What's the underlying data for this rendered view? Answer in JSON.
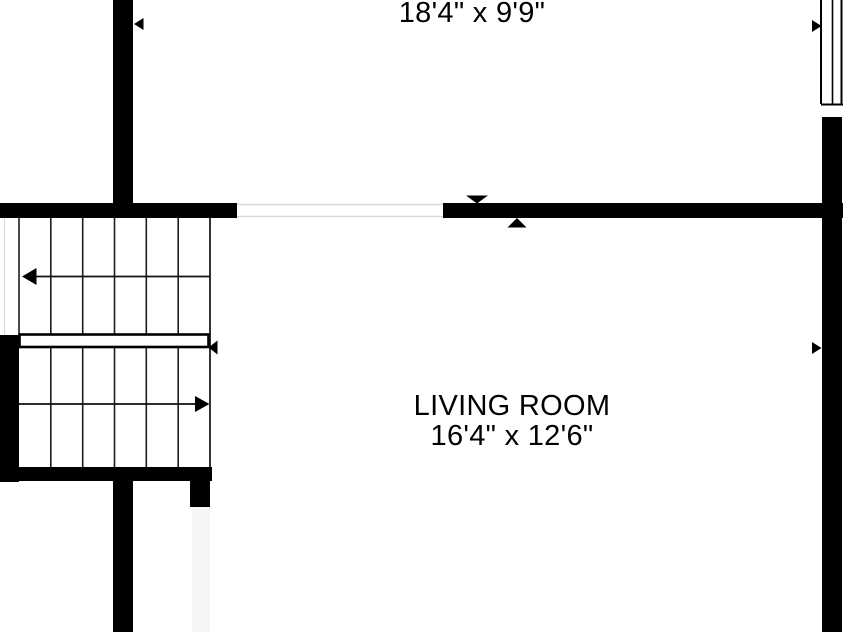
{
  "page": {
    "type": "floor-plan",
    "floor_shown": "living level with staircase"
  },
  "labels": {
    "upper_room_dimensions": "18'4\" x 9'9\"",
    "living_room_name": "LIVING ROOM",
    "living_room_dimensions": "16'4\" x 12'6\""
  },
  "stairs": {
    "upper_flight": {
      "treads": 6,
      "arrow_direction": "left"
    },
    "lower_flight": {
      "treads": 6,
      "arrow_direction": "right"
    },
    "landing_rail": {
      "end_arrow_direction": "left"
    }
  },
  "markers": {
    "left_wall_marker": "left-pointing triangle on upper-left wall",
    "window_marker": "right-pointing triangle at top-right window",
    "right_wall_marker": "right-pointing triangle on right wall",
    "opening_markers": "down and up triangles flanking wall opening"
  },
  "colors": {
    "wall": "#000000",
    "background": "#ffffff",
    "stair_line": "#1c1c1c",
    "opening_line": "#d9d9d9"
  }
}
